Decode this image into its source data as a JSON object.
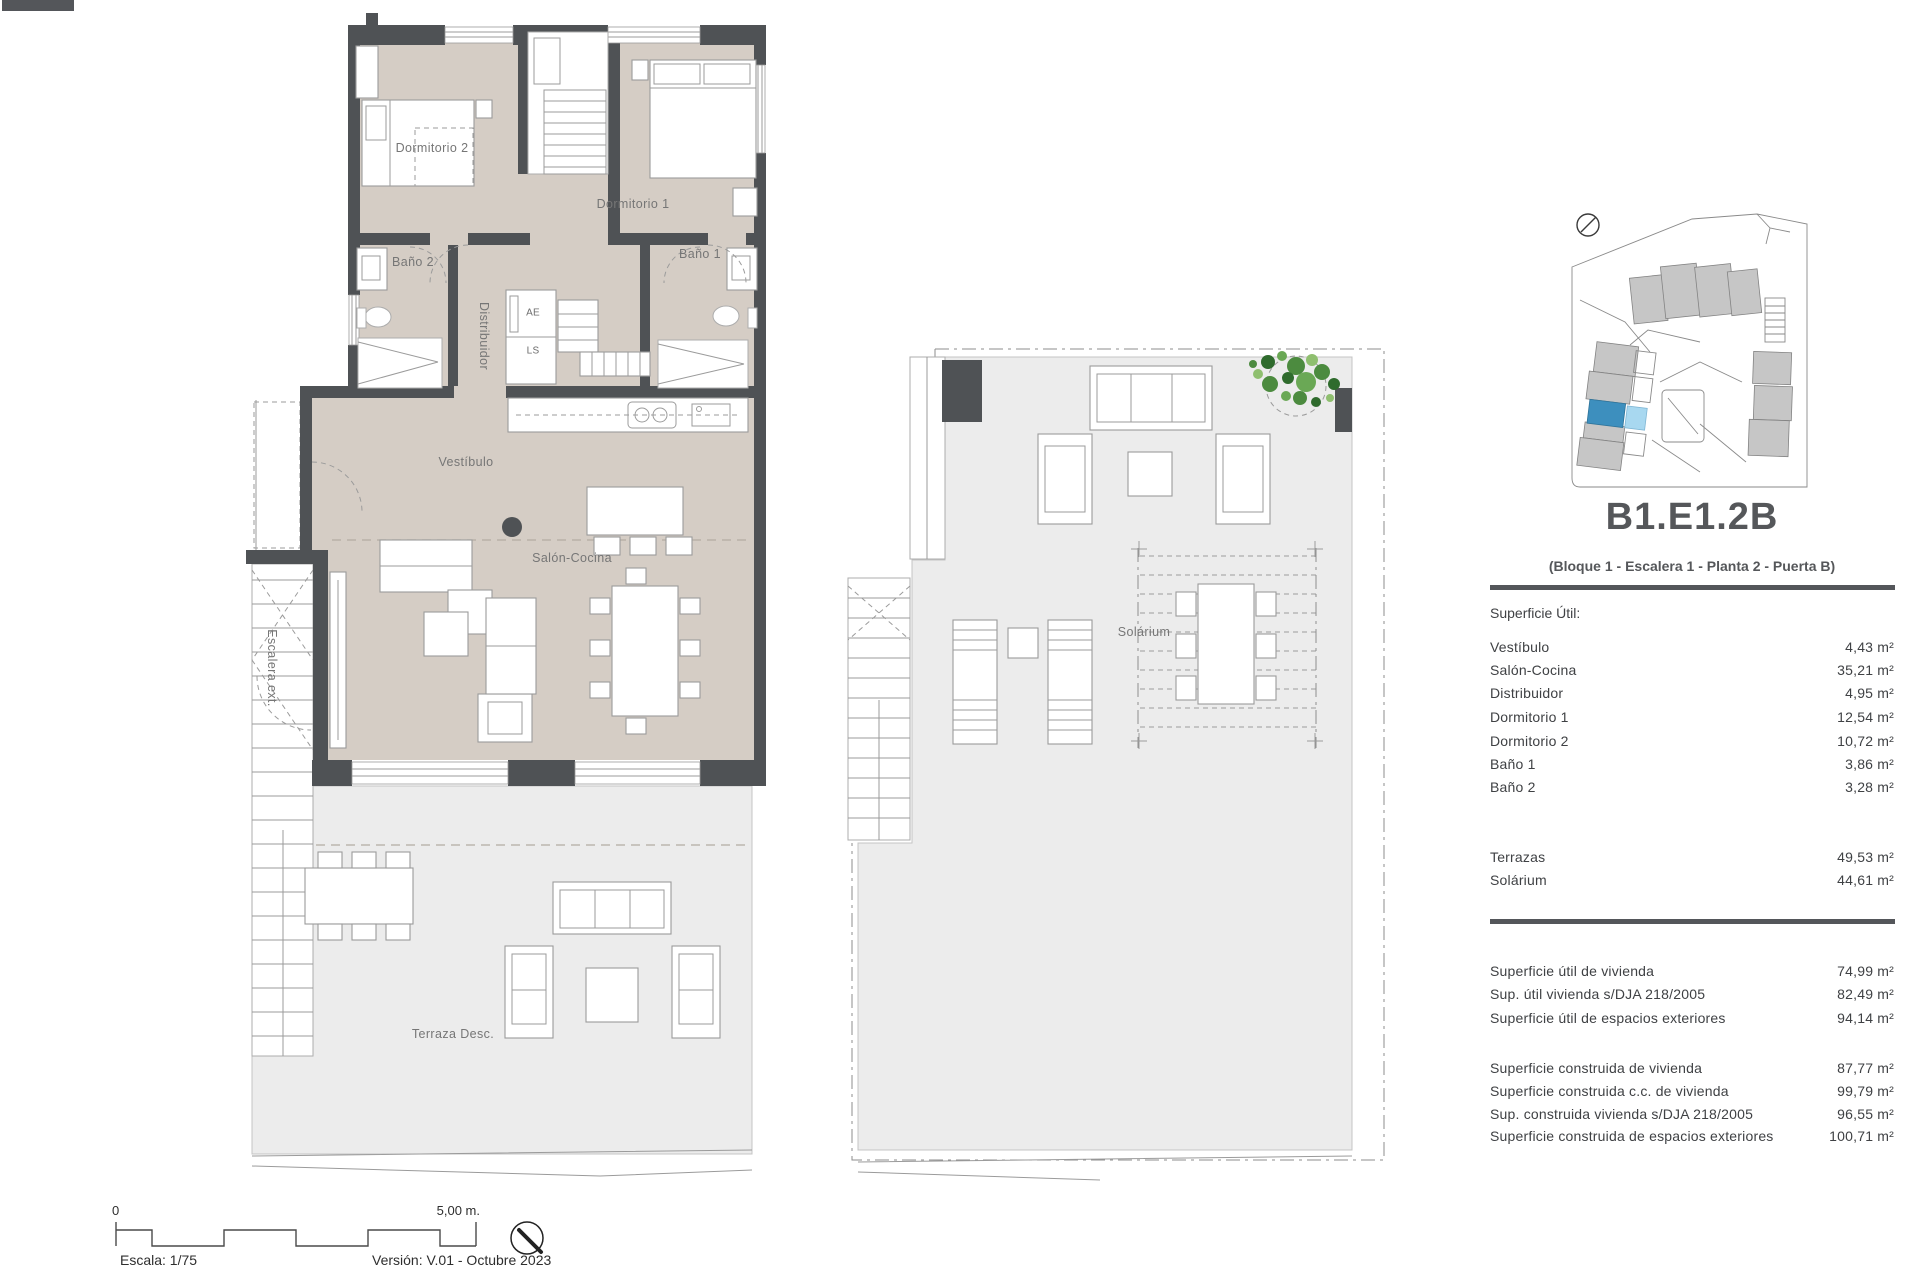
{
  "colors": {
    "wall": "#4f5255",
    "floor_interior": "#d5cdc5",
    "floor_exterior": "#ececec",
    "unit_highlight": "#3d8fbe",
    "unit_highlight_light": "#a8d8f0",
    "panel_text": "#3f4144",
    "rule": "#54565a"
  },
  "plan_main": {
    "labels": {
      "dormitorio2": "Dormitorio 2",
      "dormitorio1": "Dormitorio 1",
      "bano2": "Baño 2",
      "bano1": "Baño 1",
      "distribuidor": "Distribuidor",
      "vestibulo": "Vestíbulo",
      "salon": "Salón-Cocina",
      "escalera": "Escalera ext.",
      "terraza": "Terraza Desc.",
      "closet_ae": "AE",
      "closet_ls": "LS"
    }
  },
  "plan_solarium": {
    "label": "Solárium"
  },
  "panel": {
    "title": "B1.E1.2B",
    "subtitle": "(Bloque 1 - Escalera 1 - Planta 2 - Puerta B)",
    "superficie_util": {
      "heading": "Superficie Útil:",
      "rows": [
        {
          "label": "Vestíbulo",
          "value": "4,43 m²"
        },
        {
          "label": "Salón-Cocina",
          "value": "35,21 m²"
        },
        {
          "label": "Distribuidor",
          "value": "4,95 m²"
        },
        {
          "label": "Dormitorio 1",
          "value": "12,54 m²"
        },
        {
          "label": "Dormitorio 2",
          "value": "10,72 m²"
        },
        {
          "label": "Baño 1",
          "value": "3,86 m²"
        },
        {
          "label": "Baño 2",
          "value": "3,28 m²"
        }
      ]
    },
    "exteriores": {
      "rows": [
        {
          "label": "Terrazas",
          "value": "49,53 m²"
        },
        {
          "label": "Solárium",
          "value": "44,61 m²"
        }
      ]
    },
    "resumen_util": {
      "rows": [
        {
          "label": "Superficie útil de vivienda",
          "value": "74,99 m²"
        },
        {
          "label": "Sup. útil vivienda s/DJA 218/2005",
          "value": "82,49 m²"
        },
        {
          "label": "Superficie útil de espacios exteriores",
          "value": "94,14 m²"
        }
      ]
    },
    "resumen_construida": {
      "rows": [
        {
          "label": "Superficie construida de vivienda",
          "value": "87,77 m²"
        },
        {
          "label": "Superficie construida c.c. de vivienda",
          "value": "99,79 m²"
        },
        {
          "label": "Sup. construida vivienda s/DJA 218/2005",
          "value": "96,55 m²"
        },
        {
          "label": "Superficie construida de espacios exteriores",
          "value": "100,71 m²"
        }
      ]
    }
  },
  "footer": {
    "scale_start": "0",
    "scale_end": "5,00 m.",
    "scale_text": "Escala: 1/75",
    "version_text": "Versión: V.01 - Octubre 2023"
  }
}
